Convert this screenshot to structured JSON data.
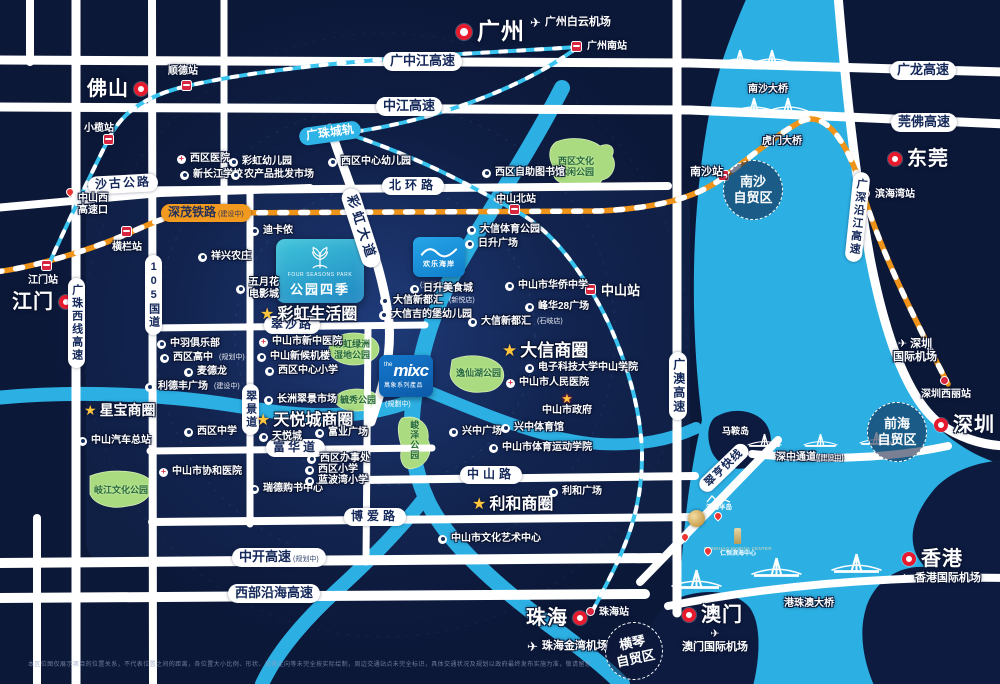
{
  "map": {
    "title": "公园四季区位图",
    "colors": {
      "land": "#0d1b40",
      "water": "#2cb0e4",
      "road": "#ffffff",
      "rail_orange": "#f29a1f",
      "rail_cyan": "#38c4ef",
      "park": "#aadb80",
      "marker_red": "#e61b2e",
      "star_gold": "#ffc53d"
    },
    "landmarks": {
      "four_seasons": {
        "en": "FOUR SEASONS PARK",
        "zh": "公园四季"
      },
      "happy_coast": {
        "zh": "欢乐海岸",
        "status": "(规划中)"
      },
      "mixc": {
        "the": "the",
        "mixc": "mixc",
        "sub": "萬象系列產品",
        "status": "(規劃中)"
      }
    },
    "cities": [
      {
        "t": "广州",
        "x": 456,
        "y": 18,
        "fs": 23,
        "rs": 16,
        "o": "rt"
      },
      {
        "t": "佛山",
        "x": 87,
        "y": 77,
        "fs": 20,
        "rs": 14,
        "o": "tr"
      },
      {
        "t": "江门",
        "x": 12,
        "y": 290,
        "fs": 20,
        "rs": 14,
        "o": "tr"
      },
      {
        "t": "东莞",
        "x": 888,
        "y": 147,
        "fs": 20,
        "rs": 14,
        "o": "rt"
      },
      {
        "t": "深圳",
        "x": 934,
        "y": 413,
        "fs": 20,
        "rs": 14,
        "o": "rt"
      },
      {
        "t": "珠海",
        "x": 526,
        "y": 606,
        "fs": 20,
        "rs": 14,
        "o": "tr"
      },
      {
        "t": "澳门",
        "x": 682,
        "y": 603,
        "fs": 20,
        "rs": 14,
        "o": "rt"
      },
      {
        "t": "香港",
        "x": 902,
        "y": 547,
        "fs": 20,
        "rs": 14,
        "o": "rt"
      }
    ],
    "stations": [
      {
        "t": "顺德站",
        "x": 186,
        "y": 85,
        "tx": 168,
        "ty": 66
      },
      {
        "t": "小榄站",
        "x": 108,
        "y": 139,
        "tx": 84,
        "ty": 123
      },
      {
        "t": "横栏站",
        "x": 126,
        "y": 231,
        "tx": 112,
        "ty": 242
      },
      {
        "t": "江门站",
        "x": 46,
        "y": 265,
        "tx": 28,
        "ty": 275
      },
      {
        "t": "广州南站",
        "x": 576,
        "y": 46,
        "tx": 587,
        "ty": 41
      },
      {
        "t": "中山北站",
        "x": 514,
        "y": 209,
        "tx": 496,
        "ty": 194
      },
      {
        "t": "中山站",
        "x": 590,
        "y": 289,
        "tx": 601,
        "ty": 283,
        "fs": 13
      },
      {
        "t": "南沙站",
        "x": 723,
        "y": 175,
        "tx": 690,
        "ty": 166,
        "fs": 11
      },
      {
        "t": "滨海湾站",
        "x": 866,
        "y": 194,
        "tx": 875,
        "ty": 189,
        "dot": 1
      },
      {
        "t": "深圳西丽站",
        "x": 945,
        "y": 381,
        "tx": 921,
        "ty": 389,
        "dot": 1
      },
      {
        "t": "珠海站",
        "x": 591,
        "y": 612,
        "tx": 599,
        "ty": 607,
        "dot": 1
      }
    ],
    "airports": [
      {
        "t": "广州白云机场",
        "x": 530,
        "y": 16,
        "fs": 11
      },
      {
        "lines": [
          "✈ 深圳",
          "国际机场"
        ],
        "x": 893,
        "y": 338,
        "fs": 11
      },
      {
        "t": "香港国际机场",
        "x": 900,
        "y": 572,
        "fs": 11
      },
      {
        "lines": [
          "✈",
          "澳门国际机场"
        ],
        "x": 682,
        "y": 628,
        "fs": 11
      },
      {
        "t": "珠海金湾机场",
        "x": 527,
        "y": 640,
        "fs": 11
      }
    ],
    "road_labels": [
      {
        "t": "广中江高速",
        "x": 383,
        "y": 52,
        "fs": 13,
        "s": "pill"
      },
      {
        "t": "广龙高速",
        "x": 890,
        "y": 61,
        "fs": 13,
        "s": "pill"
      },
      {
        "t": "中江高速",
        "x": 376,
        "y": 97,
        "fs": 13,
        "s": "pill"
      },
      {
        "t": "莞佛高速",
        "x": 891,
        "y": 113,
        "fs": 13,
        "s": "pill"
      },
      {
        "t": "北环路",
        "x": 382,
        "y": 177,
        "fs": 12,
        "ls": 4,
        "s": "pill"
      },
      {
        "t": "沙古公路",
        "x": 88,
        "y": 175,
        "fs": 12,
        "ls": 2,
        "s": "pill",
        "rot": -3
      },
      {
        "t": "翠沙路",
        "x": 264,
        "y": 316,
        "fs": 12,
        "ls": 2,
        "s": "pill"
      },
      {
        "t": "富华道",
        "x": 266,
        "y": 439,
        "fs": 12,
        "ls": 3,
        "s": "pill"
      },
      {
        "t": "中山路",
        "x": 460,
        "y": 466,
        "fs": 12,
        "ls": 4,
        "s": "pill"
      },
      {
        "t": "博爱路",
        "x": 344,
        "y": 508,
        "fs": 12,
        "ls": 4,
        "s": "pill"
      },
      {
        "t": "中开高速",
        "x": 232,
        "y": 548,
        "fs": 13,
        "s": "pill",
        "sfx": "(规划中)"
      },
      {
        "t": "西部沿海高速",
        "x": 228,
        "y": 584,
        "fs": 13,
        "s": "pill"
      },
      {
        "t": "深茂铁路",
        "x": 161,
        "y": 204,
        "fs": 12,
        "s": "pill-orange",
        "sfx": "(建设中)"
      },
      {
        "t": "广珠城轨",
        "x": 330,
        "y": 133,
        "fs": 12,
        "s": "pill-cyan",
        "rot": -8,
        "ctr": 1
      },
      {
        "t": "彩虹大道",
        "x": 361,
        "y": 228,
        "fs": 13,
        "ls": 4,
        "s": "pill",
        "rot": 72,
        "ctr": 1
      },
      {
        "t": "翠亨快线",
        "x": 724,
        "y": 468,
        "fs": 11,
        "ls": 1,
        "s": "pill",
        "rot": -44,
        "ctr": 1
      },
      {
        "t": "105国道",
        "x": 145,
        "y": 255,
        "fs": 11,
        "s": "pill-v"
      },
      {
        "t": "广珠西线高速",
        "x": 68,
        "y": 278,
        "fs": 11,
        "s": "pill-v"
      },
      {
        "t": "翠景道",
        "x": 242,
        "y": 384,
        "fs": 11,
        "s": "pill-v"
      },
      {
        "t": "广澳高速",
        "x": 669,
        "y": 352,
        "fs": 12,
        "s": "pill-v"
      },
      {
        "t": "广深沿江高速",
        "x": 849,
        "y": 172,
        "fs": 11,
        "s": "pill-v",
        "rot": 6
      },
      {
        "t": "深中通道",
        "x": 776,
        "y": 452,
        "fs": 10,
        "s": "water",
        "sfx": "(建设中)"
      },
      {
        "t": "港珠澳大桥",
        "x": 784,
        "y": 598,
        "fs": 10,
        "s": "water"
      },
      {
        "t": "南沙大桥",
        "x": 748,
        "y": 84,
        "fs": 10,
        "s": "water"
      },
      {
        "t": "虎门大桥",
        "x": 762,
        "y": 136,
        "fs": 10,
        "s": "water"
      },
      {
        "t": "马鞍岛",
        "x": 722,
        "y": 426,
        "fs": 9,
        "s": "water"
      },
      {
        "lines": [
          "中山西",
          "高速口"
        ],
        "x": 78,
        "y": 193,
        "fs": 10,
        "s": "plain2"
      }
    ],
    "ftz": [
      {
        "lines": [
          "南沙",
          "自贸区"
        ],
        "cx": 753,
        "cy": 190,
        "r": 30,
        "fs": 13
      },
      {
        "lines": [
          "前海",
          "自贸区"
        ],
        "cx": 897,
        "cy": 432,
        "r": 30,
        "fs": 13
      },
      {
        "lines": [
          "横琴",
          "自贸区"
        ],
        "cx": 634,
        "cy": 651,
        "r": 29,
        "fs": 13,
        "rot": -12
      }
    ],
    "biz_circles": [
      {
        "t": "彩虹生活圈",
        "x": 260,
        "y": 305,
        "fs": 16
      },
      {
        "t": "大信商圈",
        "x": 502,
        "y": 341,
        "fs": 17
      },
      {
        "t": "天悦城商圈",
        "x": 256,
        "y": 411,
        "fs": 16
      },
      {
        "t": "星宝商圈",
        "x": 84,
        "y": 402,
        "fs": 14
      },
      {
        "t": "利和商圈",
        "x": 472,
        "y": 495,
        "fs": 16
      }
    ],
    "parks": [
      {
        "lines": [
          "西区文化",
          "休闲公园"
        ],
        "x": 558,
        "y": 156
      },
      {
        "lines": [
          "彩虹绿洲",
          "湿地公园"
        ],
        "x": 334,
        "y": 339
      },
      {
        "t": "逸仙湖公园",
        "x": 456,
        "y": 368
      },
      {
        "t": "毓秀公园",
        "x": 340,
        "y": 395
      },
      {
        "t": "峻泽公园",
        "x": 408,
        "y": 420,
        "v": 1
      },
      {
        "t": "岐江文化公园",
        "x": 94,
        "y": 485
      }
    ],
    "pois": [
      {
        "t": "西区医院",
        "x": 181,
        "y": 159,
        "ic": "hosp"
      },
      {
        "t": "彩虹幼儿园",
        "x": 233,
        "y": 162,
        "ic": "school"
      },
      {
        "t": "西区中心幼儿园",
        "x": 332,
        "y": 162,
        "ic": "school"
      },
      {
        "t": "新长江学校",
        "x": 184,
        "y": 175,
        "ic": "school"
      },
      {
        "t": "农产品批发市场",
        "x": 235,
        "y": 175,
        "ic": "market"
      },
      {
        "t": "西区自助图书馆",
        "x": 486,
        "y": 173,
        "ic": "library"
      },
      {
        "t": "迪卡侬",
        "x": 254,
        "y": 231,
        "ic": "shop"
      },
      {
        "t": "祥兴农庄",
        "x": 202,
        "y": 257,
        "ic": "farm"
      },
      {
        "lines": [
          "五月花",
          "电影城"
        ],
        "x": 240,
        "y": 283,
        "ic": "cinema"
      },
      {
        "t": "中羽俱乐部",
        "x": 161,
        "y": 344,
        "ic": "club"
      },
      {
        "t": "西区高中",
        "x": 164,
        "y": 358,
        "ic": "school",
        "sfx": "(规划中)"
      },
      {
        "t": "麦德龙",
        "x": 188,
        "y": 372,
        "ic": "shop"
      },
      {
        "t": "利德丰广场",
        "x": 149,
        "y": 387,
        "ic": "shop",
        "sfx": "(建设中)"
      },
      {
        "t": "中山市新中医院",
        "x": 263,
        "y": 342,
        "ic": "hosp"
      },
      {
        "t": "中山新候机楼",
        "x": 261,
        "y": 357,
        "ic": "terminal"
      },
      {
        "t": "西区中心小学",
        "x": 269,
        "y": 371,
        "ic": "school"
      },
      {
        "t": "长洲翠景市场",
        "x": 268,
        "y": 400,
        "ic": "market"
      },
      {
        "t": "西区中学",
        "x": 188,
        "y": 432,
        "ic": "school"
      },
      {
        "t": "天悦城",
        "x": 263,
        "y": 437,
        "ic": "shop"
      },
      {
        "t": "富业广场",
        "x": 319,
        "y": 433,
        "ic": "shop"
      },
      {
        "t": "西区办事处",
        "x": 311,
        "y": 459,
        "ic": "gov"
      },
      {
        "t": "西区小学",
        "x": 309,
        "y": 470,
        "ic": "school"
      },
      {
        "t": "瑞德购书中心",
        "x": 254,
        "y": 489,
        "ic": "shop"
      },
      {
        "t": "蓝波湾小学",
        "x": 309,
        "y": 481,
        "ic": "school"
      },
      {
        "t": "中山市协和医院",
        "x": 163,
        "y": 472,
        "ic": "hosp"
      },
      {
        "t": "中山汽车总站",
        "x": 82,
        "y": 441,
        "ic": "bus"
      },
      {
        "t": "大信体育公园",
        "x": 471,
        "y": 230,
        "ic": "sport"
      },
      {
        "t": "日升广场",
        "x": 469,
        "y": 244,
        "ic": "shop"
      },
      {
        "t": "日升美食城",
        "x": 414,
        "y": 289,
        "ic": "food"
      },
      {
        "t": "大信新都汇",
        "x": 384,
        "y": 301,
        "ic": "shop",
        "sfx": "(新悦店)"
      },
      {
        "t": "大信吉的堡幼儿园",
        "x": 383,
        "y": 315,
        "ic": "school"
      },
      {
        "t": "大信新都汇",
        "x": 472,
        "y": 322,
        "ic": "shop",
        "sfx": "(石岐店)"
      },
      {
        "t": "中山市华侨中学",
        "x": 509,
        "y": 286,
        "ic": "school"
      },
      {
        "t": "峰华28广场",
        "x": 529,
        "y": 307,
        "ic": "shop"
      },
      {
        "t": "电子科技大学中山学院",
        "x": 529,
        "y": 368,
        "ic": "school"
      },
      {
        "t": "中山市人民医院",
        "x": 510,
        "y": 383,
        "ic": "hosp"
      },
      {
        "t": "中山市政府",
        "x": 567,
        "y": 398,
        "ic": "gov-star"
      },
      {
        "t": "兴中广场",
        "x": 453,
        "y": 432,
        "ic": "shop"
      },
      {
        "t": "兴中体育馆",
        "x": 505,
        "y": 428,
        "ic": "sport"
      },
      {
        "t": "中山市体育运动学院",
        "x": 493,
        "y": 448,
        "ic": "school"
      },
      {
        "t": "利和广场",
        "x": 553,
        "y": 492,
        "ic": "shop"
      },
      {
        "t": "中山市文化艺术中心",
        "x": 442,
        "y": 539,
        "ic": "culture"
      }
    ],
    "water_logos": [
      {
        "type": "mountain",
        "caption": "滨海半岛",
        "x": 706,
        "y": 494
      },
      {
        "type": "crest",
        "x": 688,
        "y": 510
      },
      {
        "type": "tower",
        "en": "RONGHAO MARINA CENTER",
        "zh": "仁恒滨海中心",
        "x": 738,
        "y": 528
      },
      {
        "type": "pin",
        "x": 714,
        "y": 512
      },
      {
        "type": "pin",
        "x": 681,
        "y": 533
      },
      {
        "type": "pin",
        "x": 704,
        "y": 547
      },
      {
        "type": "pin",
        "x": 66,
        "y": 188
      }
    ],
    "disclaimer": "本区位图仅展示项目的位置关系，不代表位置之间的距离，各位置大小比例、形状、道路走向等未完全按实际绘制，周边交通站点未完全标识，具体交通状况及规划以政府最终发布实施为准，敬请留意"
  }
}
